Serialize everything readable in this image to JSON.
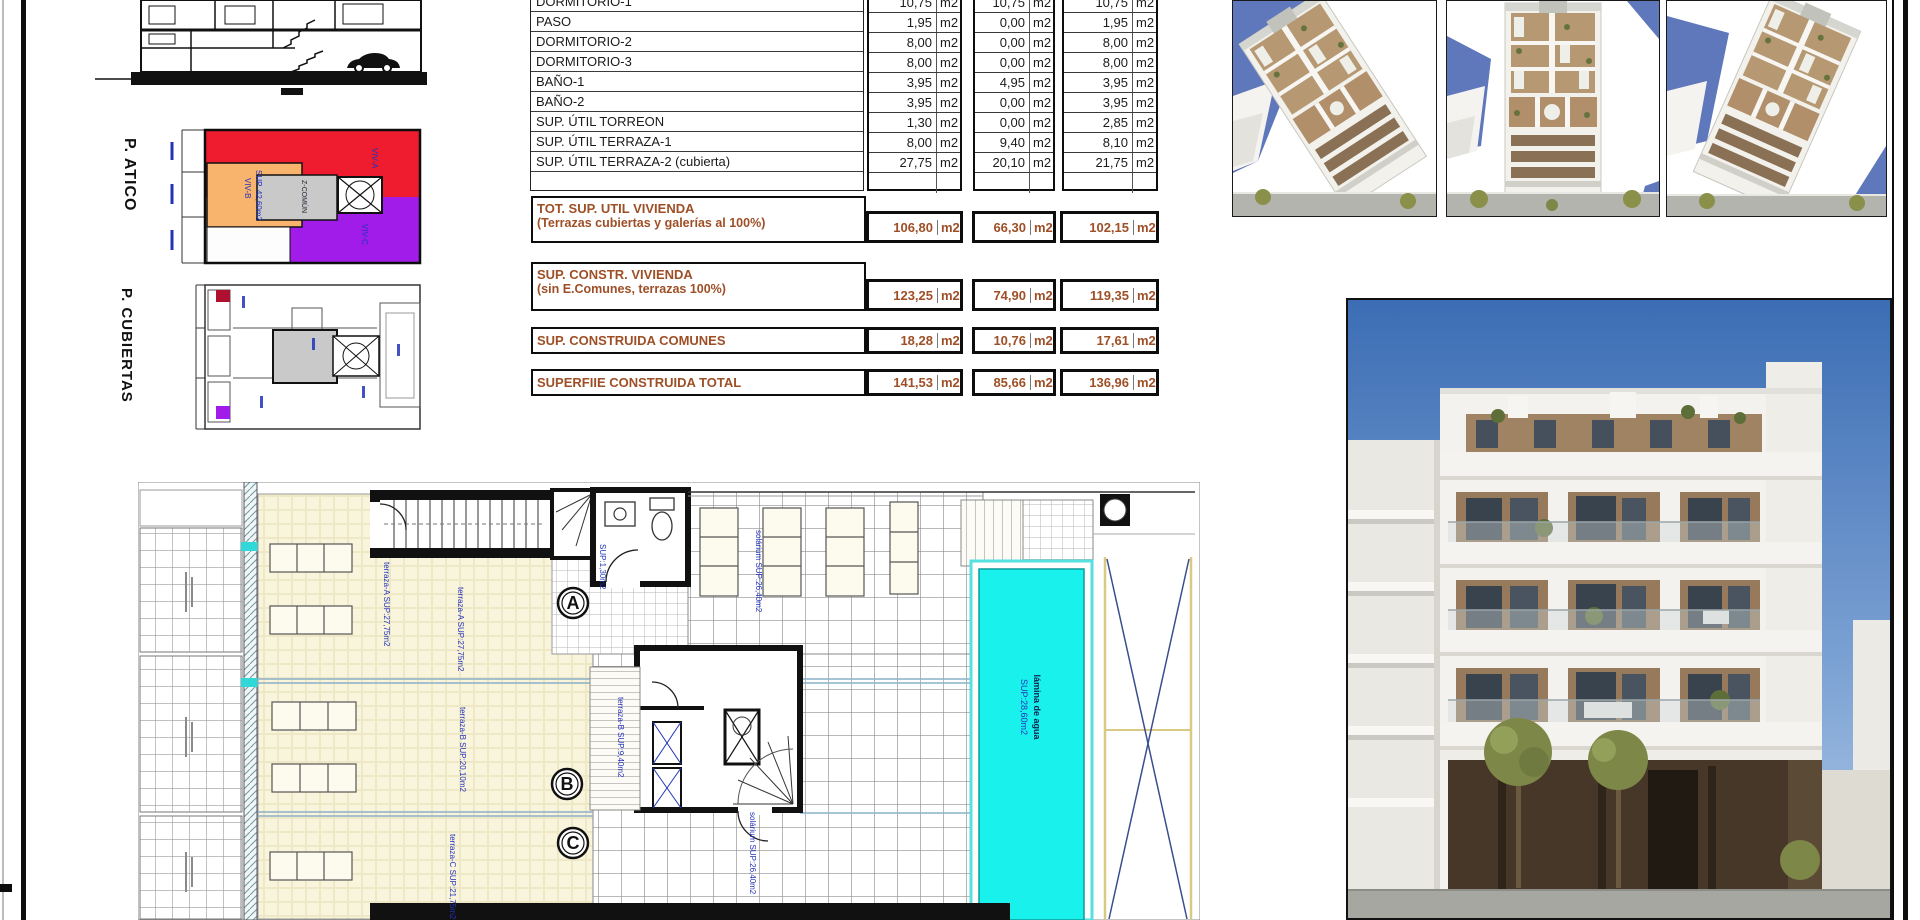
{
  "sheet": {
    "atico_label": "P. ATICO",
    "cubiertas_label": "P. CUBIERTAS"
  },
  "colors": {
    "summary_text": "#9e4f26",
    "atico_red": "#ee1c2e",
    "atico_orange": "#f8b36d",
    "atico_purple": "#a11ce8",
    "atico_gray": "#c9c9c9",
    "pool_water": "#19f2ec",
    "plan_annotation_blue": "#2233bb"
  },
  "table": {
    "unit": "m2",
    "rows": [
      {
        "label": "DORMITORIO-1",
        "v1": "10,75",
        "v2": "10,75",
        "v3": "10,75"
      },
      {
        "label": "PASO",
        "v1": "1,95",
        "v2": "0,00",
        "v3": "1,95"
      },
      {
        "label": "DORMITORIO-2",
        "v1": "8,00",
        "v2": "0,00",
        "v3": "8,00"
      },
      {
        "label": "DORMITORIO-3",
        "v1": "8,00",
        "v2": "0,00",
        "v3": "8,00"
      },
      {
        "label": "BAÑO-1",
        "v1": "3,95",
        "v2": "4,95",
        "v3": "3,95"
      },
      {
        "label": "BAÑO-2",
        "v1": "3,95",
        "v2": "0,00",
        "v3": "3,95"
      },
      {
        "label": "SUP. ÚTIL TORREON",
        "v1": "1,30",
        "v2": "0,00",
        "v3": "2,85"
      },
      {
        "label": "SUP. ÚTIL TERRAZA-1",
        "v1": "8,00",
        "v2": "9,40",
        "v3": "8,10"
      },
      {
        "label": "SUP. ÚTIL TERRAZA-2 (cubierta)",
        "v1": "27,75",
        "v2": "20,10",
        "v3": "21,75"
      },
      {
        "label": "",
        "v1": "",
        "v2": "",
        "v3": ""
      }
    ],
    "summary": [
      {
        "l1": "TOT. SUP. UTIL VIVIENDA",
        "l2": "(Terrazas cubiertas y galerías al 100%)",
        "v1": "106,80",
        "v2": "66,30",
        "v3": "102,15"
      },
      {
        "l1": "SUP. CONSTR. VIVIENDA",
        "l2": "(sin E.Comunes, terrazas 100%)",
        "v1": "123,25",
        "v2": "74,90",
        "v3": "119,35"
      },
      {
        "l1": "SUP. CONSTRUIDA COMUNES",
        "l2": "",
        "v1": "18,28",
        "v2": "10,76",
        "v3": "17,61"
      },
      {
        "l1": "SUPERFIIE CONSTRUIDA TOTAL",
        "l2": "",
        "v1": "141,53",
        "v2": "85,66",
        "v3": "136,96"
      }
    ]
  },
  "atico_plan": {
    "viv_a": "VIV-A",
    "viv_b": "VIV-B",
    "viv_b_sup": "SUP. 42,60m2",
    "viv_c": "VIV-C",
    "zcomun": "Z-COMÚN"
  },
  "floor_plan": {
    "labels": {
      "terraza_a": "terraza-A SUP:27,75m2",
      "terraza_b": "terraza-B SUP:20,10m2",
      "terraza_c": "terraza-C SUP:21,75m2",
      "torreon": "SUP:1,30m2",
      "deck": "terraza-B SUP:9,40m2",
      "solarium": "solárium SUP:26,40m2",
      "pool_1": "lámina de agua",
      "pool_2": "SUP:28,60m2",
      "marker_a": "A",
      "marker_b": "B",
      "marker_c": "C"
    }
  }
}
